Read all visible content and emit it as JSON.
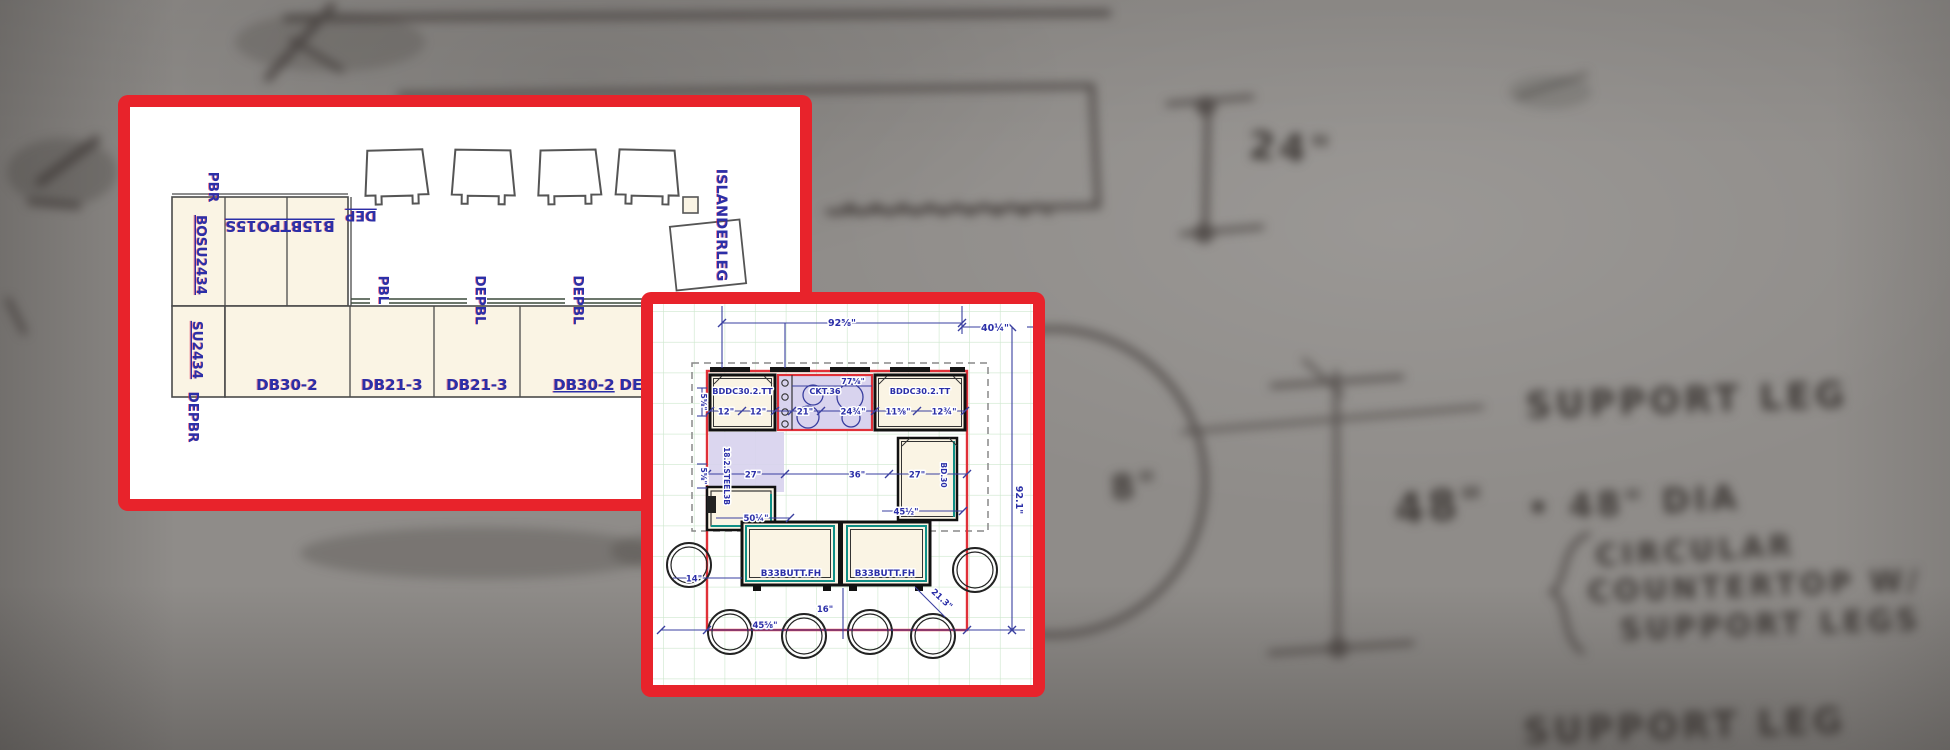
{
  "colors": {
    "panel_border": "#e8232b",
    "cad_navy": "#2b2fa8",
    "beige": "#faf4e4",
    "lavender": "#d8d3ee",
    "teal": "#0f8f86",
    "grid_green": "#cde7cd",
    "island_red": "#e03038",
    "pencil": "#453f3c"
  },
  "left_panel": {
    "labels": {
      "pbr": "PBR",
      "bosu": "BOSU2434",
      "su": "SU2434",
      "depbr": "DEPBR",
      "b15": "B15BTPO15S",
      "dep": "DEP",
      "pbl": "PBL",
      "depbl_1": "DEPBL",
      "depbl_2": "DEPBL",
      "islanderleg": "ISLANDERLEG"
    },
    "cells": [
      "DB30-2",
      "DB21-3",
      "DB21-3",
      "DB30-2",
      "DE"
    ]
  },
  "right_panel": {
    "cabinets": {
      "bddc_left": "BDDC30.2.TT",
      "cooktop": "CKT.36",
      "bddc_right": "BDDC30.2.TT",
      "steel": "18.2.STEEL3B",
      "bd30": "BD.30",
      "b33_left": "B33BUTT.FH",
      "b33_right": "B33BUTT.FH"
    },
    "dims": {
      "top_width": "92⅝\"",
      "right_offset": "40¼\"",
      "right_height": "92.1\"",
      "cooktop_width": "77⅝\"",
      "left_cab_a": "12\"",
      "left_cab_b": "12\"",
      "ck_a": "21\"",
      "ck_b": "24¾\"",
      "right_cab_a": "11⅝\"",
      "right_cab_b": "12¾\"",
      "side_a": "5⅝\"",
      "side_b": "5⅝\"",
      "mid_a": "27\"",
      "mid_b": "36\"",
      "mid_c": "27\"",
      "base_left": "50¼\"",
      "base_right": "45½\"",
      "stool_left": "14\"",
      "stool_gap": "16\"",
      "stool_diag": "21.3\"",
      "bottom": "45⅝\""
    }
  },
  "background_notes": {
    "dim24": "24\"",
    "dim8": "8\"",
    "dim48": "48\"",
    "support_leg_top": "SUPPORT LEG",
    "dia": "• 48\" DIA",
    "circular": "CIRCULAR",
    "countertop": "COUNTERTOP W/",
    "support_legs": "SUPPORT LEGS",
    "support_leg_bottom": "SUPPORT LEG"
  }
}
